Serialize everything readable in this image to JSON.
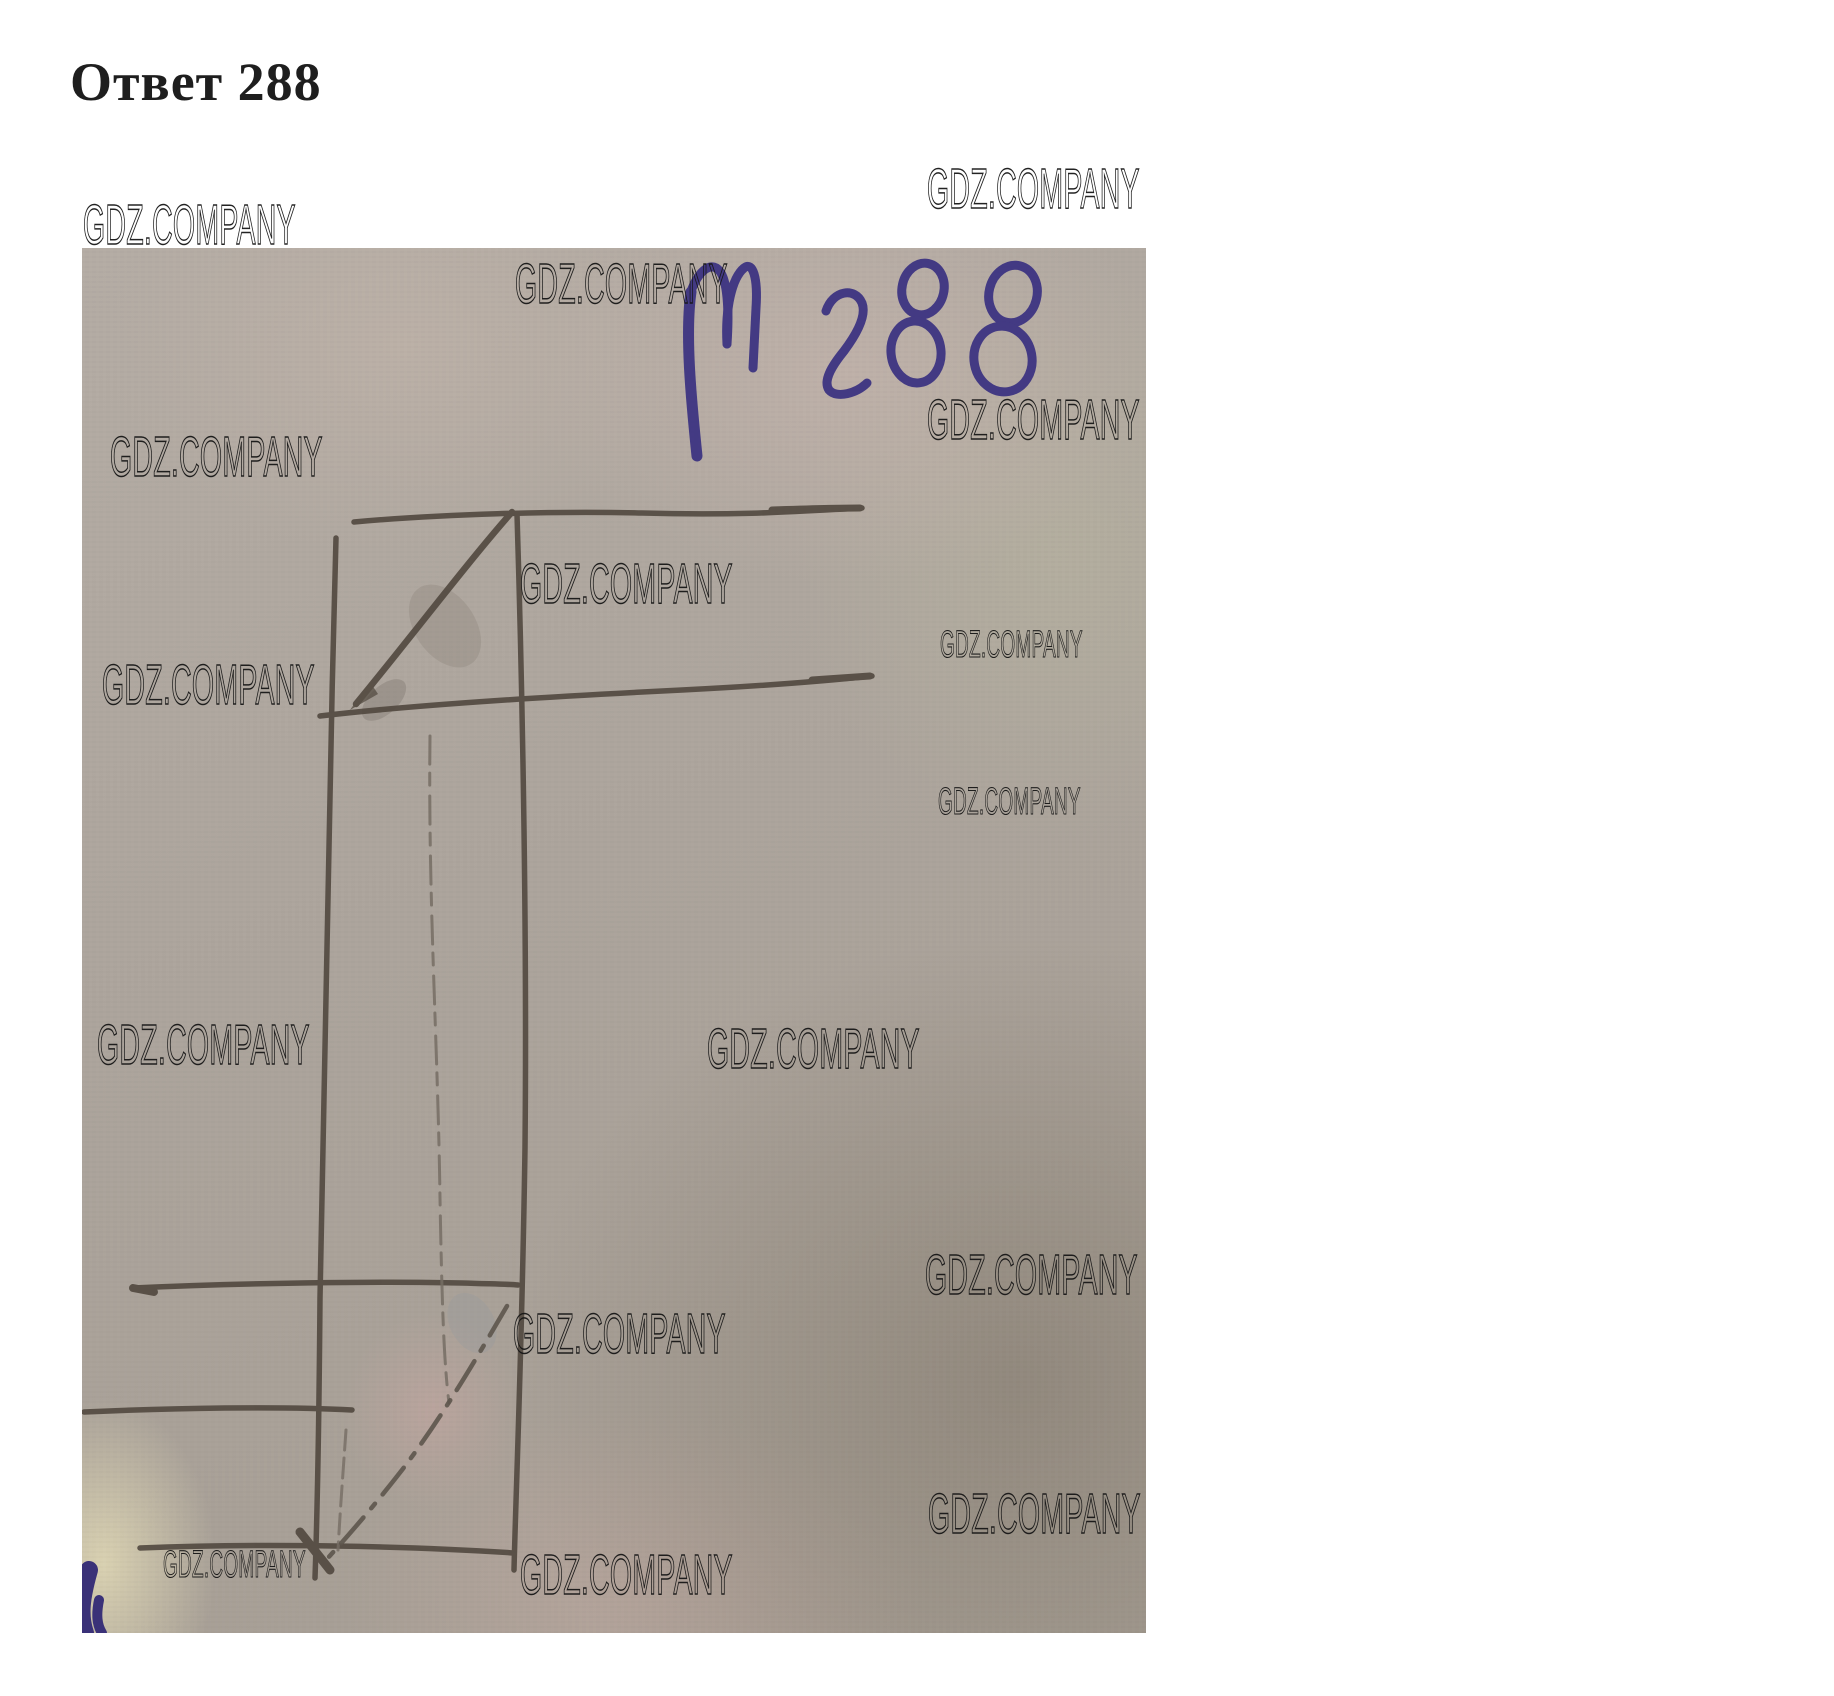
{
  "page": {
    "title": "Ответ 288",
    "background_color": "#ffffff"
  },
  "watermark": {
    "text": "GDZ.COMPANY",
    "color": "#1a1a1a",
    "count": 16
  },
  "photo": {
    "description_label": "hand-drawn pencil sketch of a rectangular prism with triangular top and bottom sections on grey notebook paper",
    "handwritten_label": "№288",
    "ink_color": "#3d3482",
    "pencil_color": "#51483f",
    "paper_base_color": "#aea69e"
  }
}
